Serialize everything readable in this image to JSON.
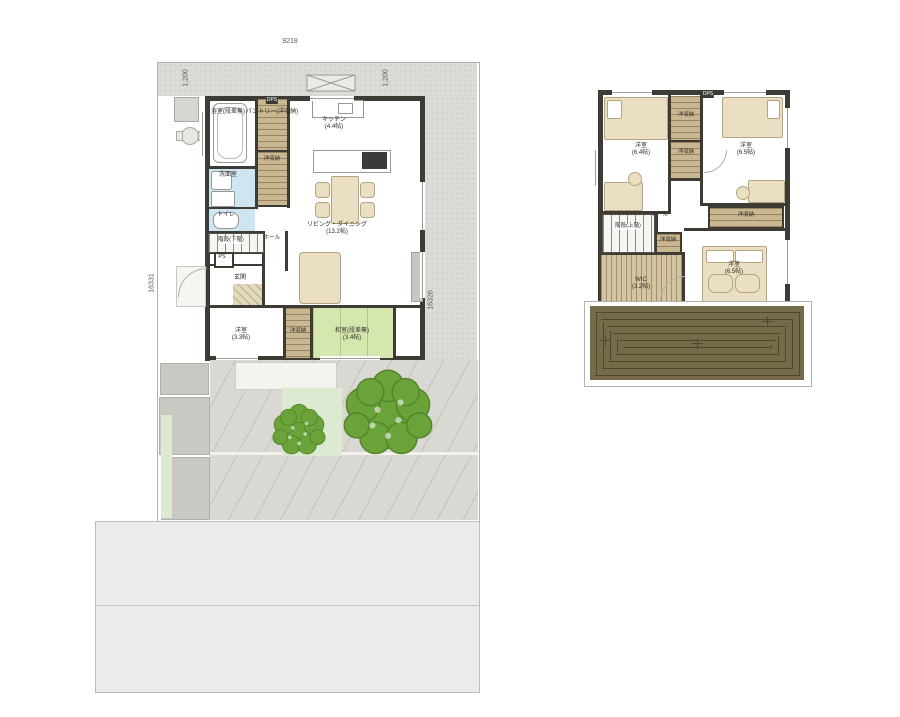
{
  "colors": {
    "wall": "#3e3b35",
    "water_blue": "#cde6f2",
    "tatami_green": "#d5e7ae",
    "closet_tan": "#c9b791",
    "deck_brown": "#756b4b",
    "tree_green": "#6aa339",
    "site_gray": "#dcdbd6",
    "road_gray": "#ebebe9"
  },
  "floor1": {
    "dim_top": "9218",
    "dim_bottom": "9209",
    "dim_left": "16331",
    "dim_right": "16326",
    "dim_offset_left": "1,200",
    "dim_offset_right": "1,200",
    "rooms": {
      "bath": "浴室(段差無)",
      "pantry": "パントリー(洋収納)",
      "dps": "DPS",
      "closet_mid": "洋収納",
      "washroom": "洗面室",
      "toilet": "トイレ",
      "stairs": "階段(下階)",
      "hall": "ホール",
      "ps": "PS",
      "entrance": "玄関",
      "kitchen": "キッチン",
      "kitchen_size": "(4.4帖)",
      "living": "リビング・ダイニング",
      "living_size": "(13.2帖)",
      "bedroom": "洋室",
      "bedroom_size": "(3.3帖)",
      "closet_south": "洋収納",
      "tatami": "和室(段差無)",
      "tatami_size": "(3.4帖)"
    }
  },
  "floor2": {
    "rooms": {
      "bedroom_nw": "洋室",
      "bedroom_nw_size": "(6.4帖)",
      "closet_n1": "洋収納",
      "closet_n2": "洋収納",
      "dps": "DPS",
      "bedroom_ne": "洋室",
      "bedroom_ne_size": "(6.5帖)",
      "stairs": "階段(上階)",
      "hall": "ホール",
      "closet_center": "洋収納",
      "closet_east": "洋収納",
      "wic": "WIC",
      "wic_size": "(3.2帖)",
      "bedroom_s": "洋室",
      "bedroom_s_size": "(6.5帖)"
    }
  }
}
